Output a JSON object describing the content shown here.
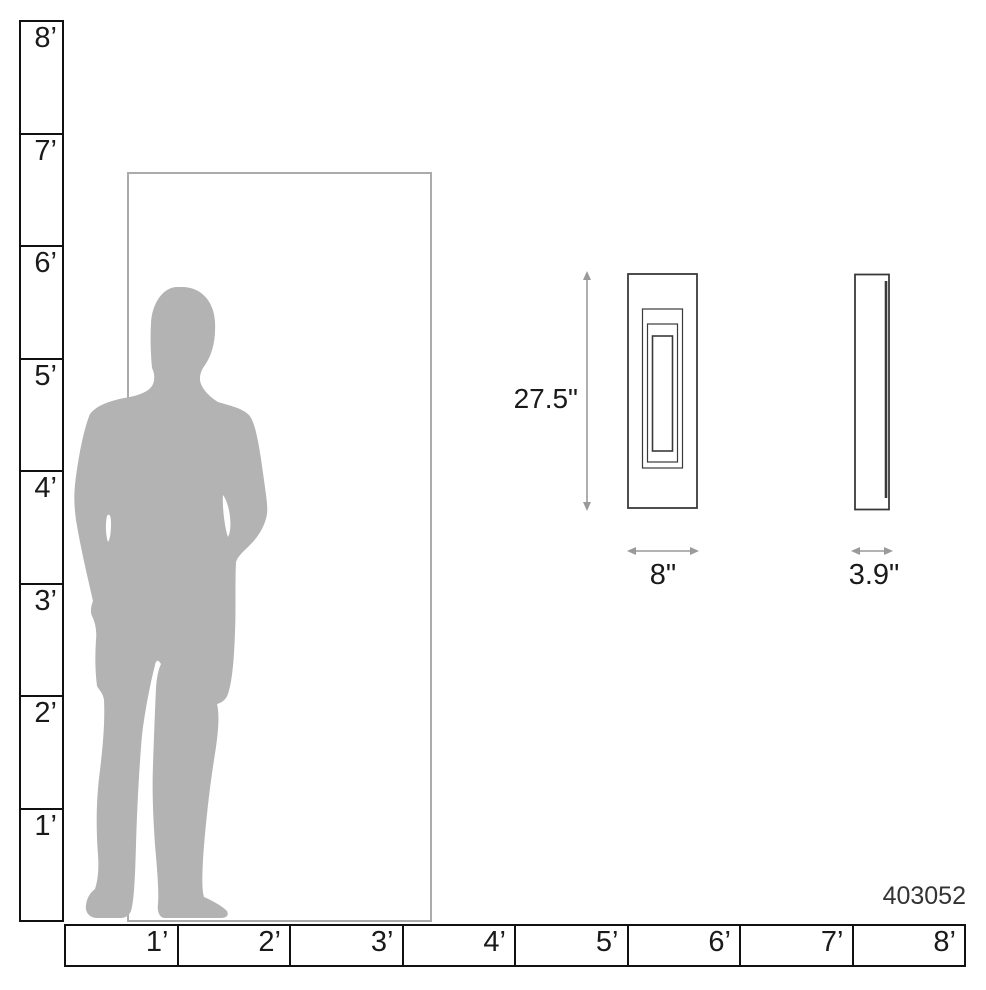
{
  "ruler": {
    "vertical_labels": [
      "8’",
      "7’",
      "6’",
      "5’",
      "4’",
      "3’",
      "2’",
      "1’"
    ],
    "horizontal_labels": [
      "1’",
      "2’",
      "3’",
      "4’",
      "5’",
      "6’",
      "7’",
      "8’"
    ]
  },
  "fixture": {
    "height_label": "27.5\"",
    "width_label": "8\"",
    "depth_label": "3.9\""
  },
  "product_number": "403052",
  "colors": {
    "silhouette_gray": "#b3b3b3",
    "door_outline_gray": "#ababab",
    "fixture_line": "#3a3a3a",
    "dimension_arrow_gray": "#9a9a9a",
    "ruler_line": "#111111",
    "label_text": "#1a1a1a"
  }
}
